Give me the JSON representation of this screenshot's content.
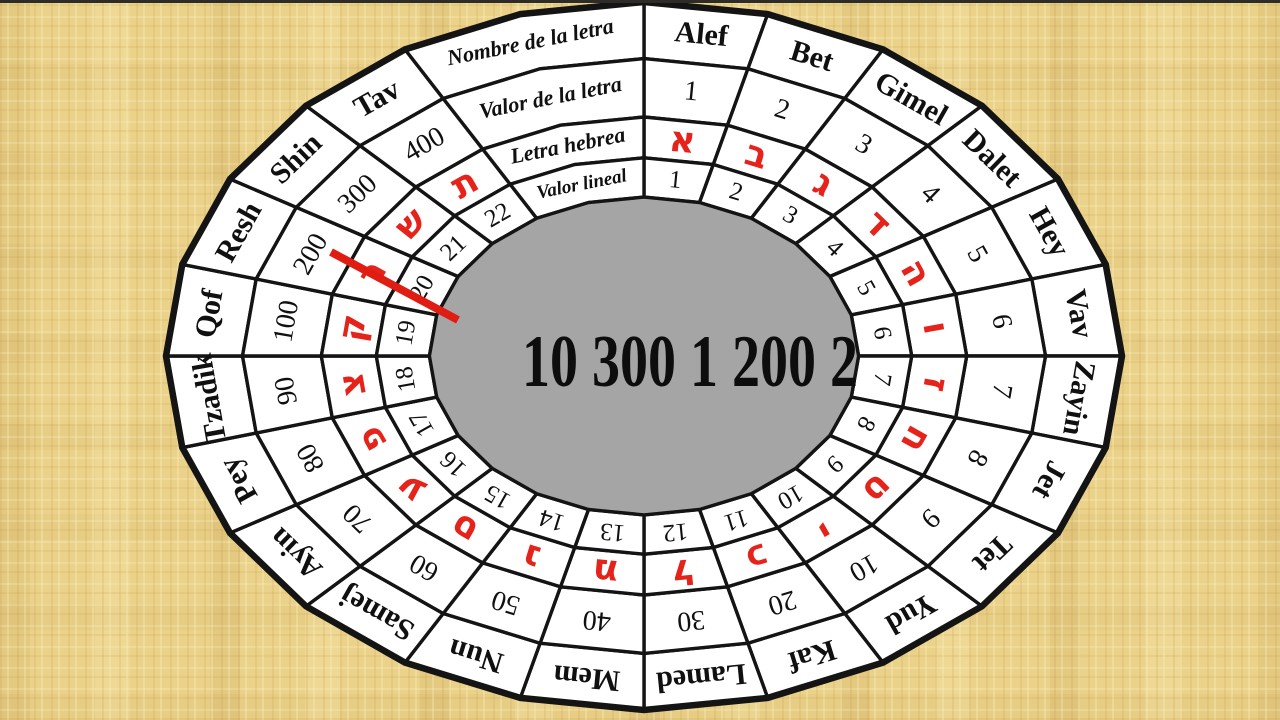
{
  "wheel": {
    "row_labels": {
      "name": "Nombre de la letra",
      "value": "Valor de la letra",
      "hebrew": "Letra hebrea",
      "lineal": "Valor lineal"
    },
    "letters": [
      {
        "name": "Alef",
        "value": "1",
        "hebrew": "א",
        "lineal": "1"
      },
      {
        "name": "Bet",
        "value": "2",
        "hebrew": "ב",
        "lineal": "2"
      },
      {
        "name": "Gimel",
        "value": "3",
        "hebrew": "ג",
        "lineal": "3"
      },
      {
        "name": "Dalet",
        "value": "4",
        "hebrew": "ד",
        "lineal": "4"
      },
      {
        "name": "Hey",
        "value": "5",
        "hebrew": "ה",
        "lineal": "5"
      },
      {
        "name": "Vav",
        "value": "6",
        "hebrew": "ו",
        "lineal": "6"
      },
      {
        "name": "Zayin",
        "value": "7",
        "hebrew": "ז",
        "lineal": "7"
      },
      {
        "name": "Jet",
        "value": "8",
        "hebrew": "ח",
        "lineal": "8"
      },
      {
        "name": "Tet",
        "value": "9",
        "hebrew": "ט",
        "lineal": "9"
      },
      {
        "name": "Yud",
        "value": "10",
        "hebrew": "י",
        "lineal": "10"
      },
      {
        "name": "Kaf",
        "value": "20",
        "hebrew": "כ",
        "lineal": "11"
      },
      {
        "name": "Lamed",
        "value": "30",
        "hebrew": "ל",
        "lineal": "12"
      },
      {
        "name": "Mem",
        "value": "40",
        "hebrew": "מ",
        "lineal": "13"
      },
      {
        "name": "Nun",
        "value": "50",
        "hebrew": "נ",
        "lineal": "14"
      },
      {
        "name": "Samej",
        "value": "60",
        "hebrew": "ס",
        "lineal": "15"
      },
      {
        "name": "Ayin",
        "value": "70",
        "hebrew": "ע",
        "lineal": "16"
      },
      {
        "name": "Pey",
        "value": "80",
        "hebrew": "פ",
        "lineal": "17"
      },
      {
        "name": "Tzadik",
        "value": "90",
        "hebrew": "צ",
        "lineal": "18"
      },
      {
        "name": "Qof",
        "value": "100",
        "hebrew": "ק",
        "lineal": "19"
      },
      {
        "name": "Resh",
        "value": "200",
        "hebrew": "ר",
        "lineal": "20"
      },
      {
        "name": "Shin",
        "value": "300",
        "hebrew": "ש",
        "lineal": "21"
      },
      {
        "name": "Tav",
        "value": "400",
        "hebrew": "ת",
        "lineal": "22"
      }
    ],
    "center_value": "10 300 1 200 2",
    "colors": {
      "cell_fill": "#ffffff",
      "line": "#141414",
      "hebrew_red": "#e5231b",
      "pointer_red": "#e01d12",
      "center_gray": "#a5a5a5",
      "background": "#ebd28a"
    }
  }
}
